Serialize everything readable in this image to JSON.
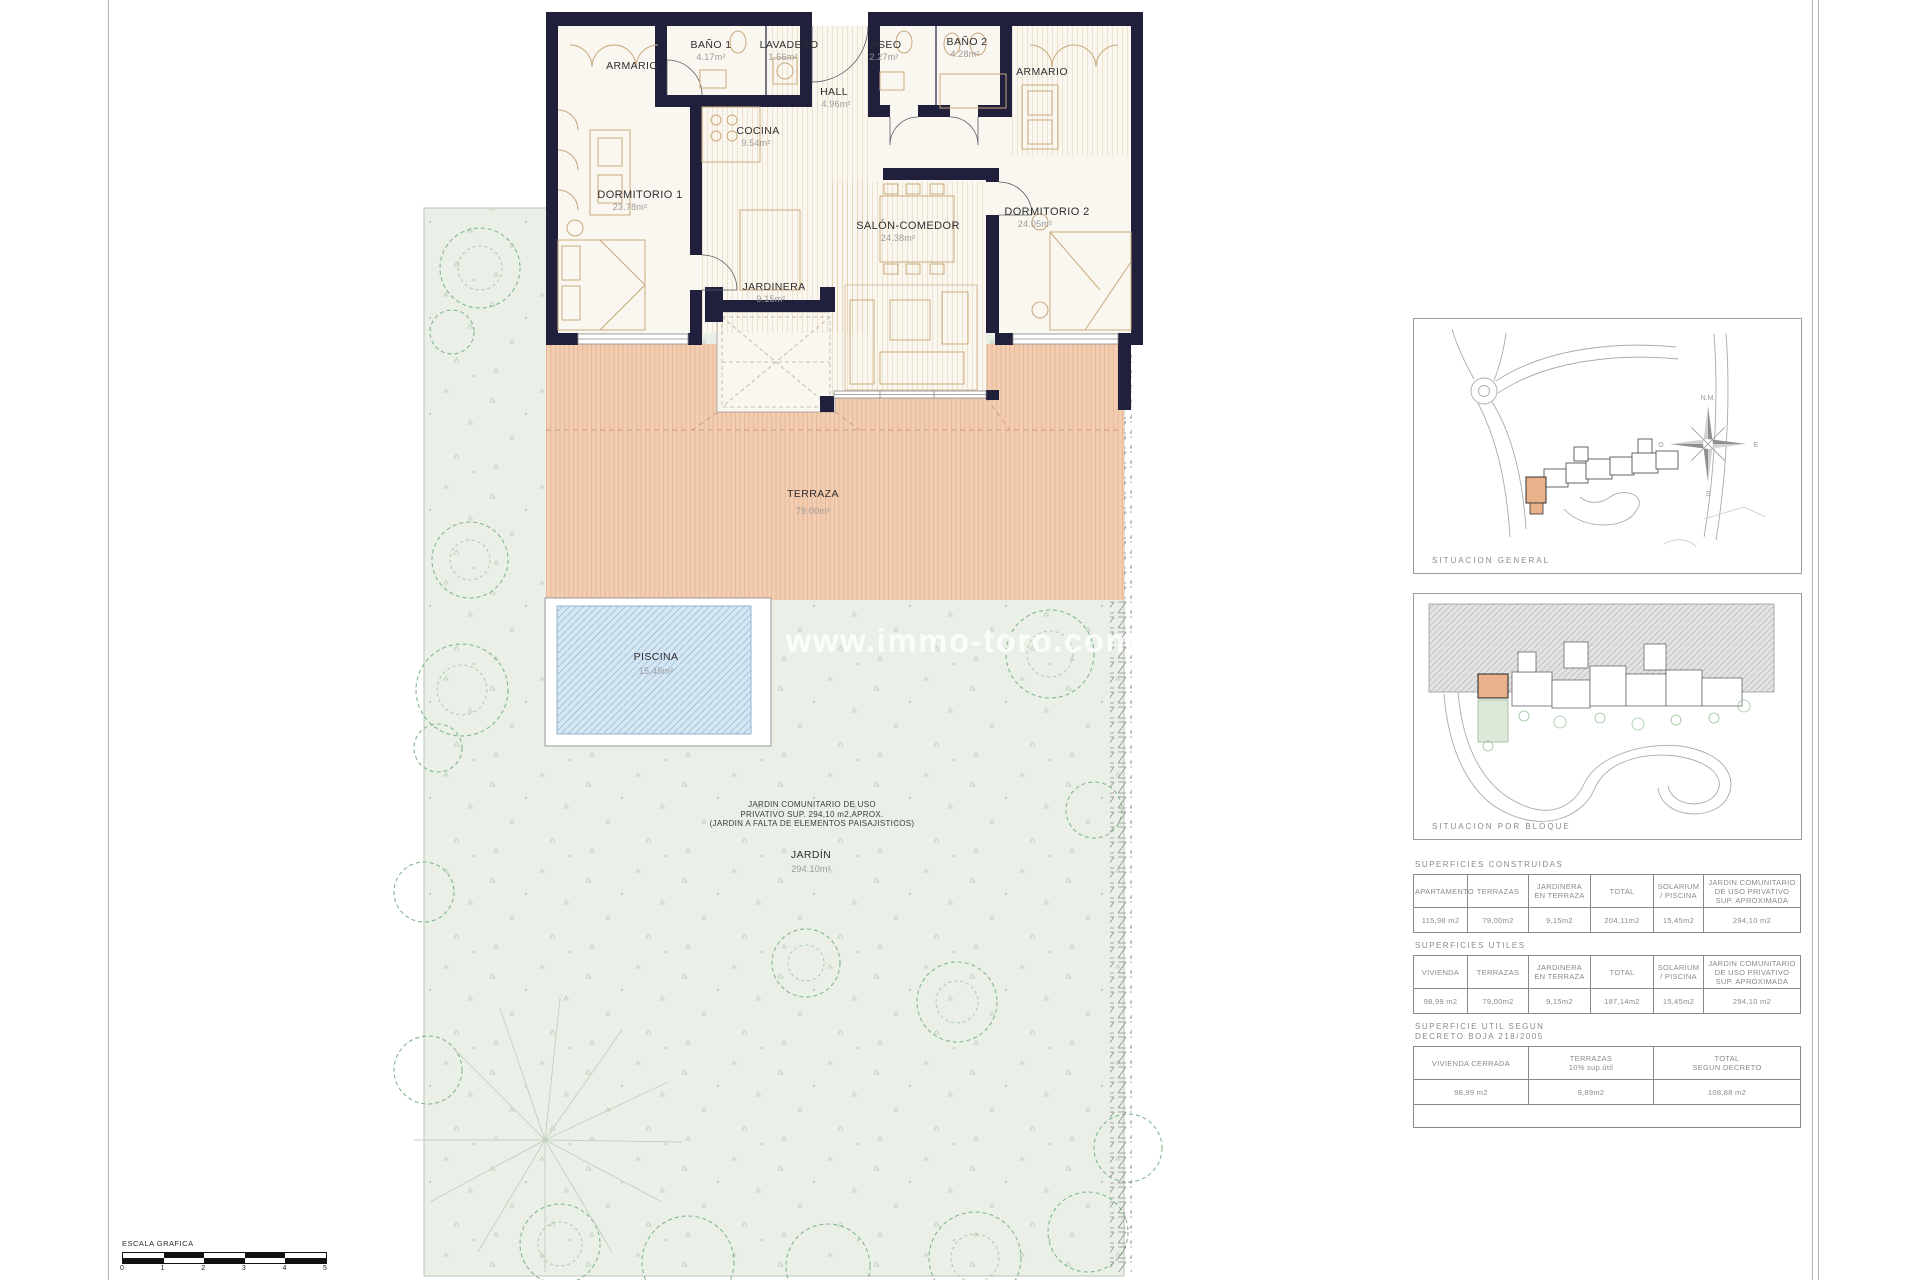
{
  "colors": {
    "wall": "#20203c",
    "terrace": "#f3cdb1",
    "pool": "#d7e7f2",
    "garden": "#eaf0e8",
    "highlight": "#e9b28b"
  },
  "watermark": "www.immo-toro.com",
  "plan": {
    "rooms": [
      {
        "label": "ARMARIO",
        "area": ""
      },
      {
        "label": "BAÑO 1",
        "area": "4.17m²"
      },
      {
        "label": "LAVADERO",
        "area": "1.56m²"
      },
      {
        "label": "ASEO",
        "area": "2.27m²"
      },
      {
        "label": "BAÑO 2",
        "area": "4.28m²"
      },
      {
        "label": "ARMARIO",
        "area": ""
      },
      {
        "label": "HALL",
        "area": "4.96m²"
      },
      {
        "label": "COCINA",
        "area": "9.54m²"
      },
      {
        "label": "DORMITORIO 1",
        "area": "23.78m²"
      },
      {
        "label": "SALÓN-COMEDOR",
        "area": "24.38m²"
      },
      {
        "label": "DORMITORIO 2",
        "area": "24.05m²"
      },
      {
        "label": "JARDINERA",
        "area": "9.15m²"
      },
      {
        "label": "TERRAZA",
        "area": "79.00m²"
      },
      {
        "label": "PISCINA",
        "area": "15.45m²"
      },
      {
        "label": "JARDÍN",
        "area": "294.10m²"
      }
    ],
    "garden_note": {
      "line1": "JARDIN COMUNITARIO  DE USO",
      "line2": "PRIVATIVO SUP. 294,10  m2,APROX.",
      "line3": "(JARDIN A FALTA DE  ELEMENTOS PAISAJISTICOS)"
    }
  },
  "sidebar": {
    "map_general": {
      "caption": "SITUACION  GENERAL",
      "compass": {
        "north": "N.M.",
        "east": "E",
        "south": "S",
        "west": "O"
      }
    },
    "map_block": {
      "caption": "SITUACION  POR  BLOQUE"
    },
    "tables": [
      {
        "title": "SUPERFICIES  CONSTRUIDAS",
        "headers": [
          "APARTAMENTO",
          "TERRAZAS",
          "JARDINERA\nEN TERRAZA",
          "TOTAL",
          "SOLARIUM\n/ PISCINA",
          "JARDIN COMUNITARIO\nDE USO  PRIVATIVO\nSUP. APROXIMADA"
        ],
        "values": [
          "115,98 m2",
          "79,00m2",
          "9,15m2",
          "204,11m2",
          "15,45m2",
          "294,10 m2"
        ]
      },
      {
        "title": "SUPERFICIES  UTILES",
        "headers": [
          "VIVIENDA",
          "TERRAZAS",
          "JARDINERA\nEN TERRAZA",
          "TOTAL",
          "SOLARIUM\n/ PISCINA",
          "JARDIN COMUNITARIO\nDE USO  PRIVATIVO\nSUP. APROXIMADA"
        ],
        "values": [
          "98,99 m2",
          "79,00m2",
          "9,15m2",
          "187,14m2",
          "15,45m2",
          "294,10 m2"
        ]
      },
      {
        "title": "SUPERFICIE UTIL SEGUN\nDECRETO BOJA 218/2005",
        "headers": [
          "VIVIENDA CERRADA",
          "TERRAZAS\n10% sup.útil",
          "TOTAL\nSEGUN DECRETO"
        ],
        "values": [
          "98,99 m2",
          "9,89m2",
          "108,88 m2"
        ]
      }
    ]
  },
  "scalebar": {
    "caption": "ESCALA GRAFICA",
    "ticks": [
      "0",
      "1",
      "2",
      "3",
      "4",
      "5"
    ]
  }
}
